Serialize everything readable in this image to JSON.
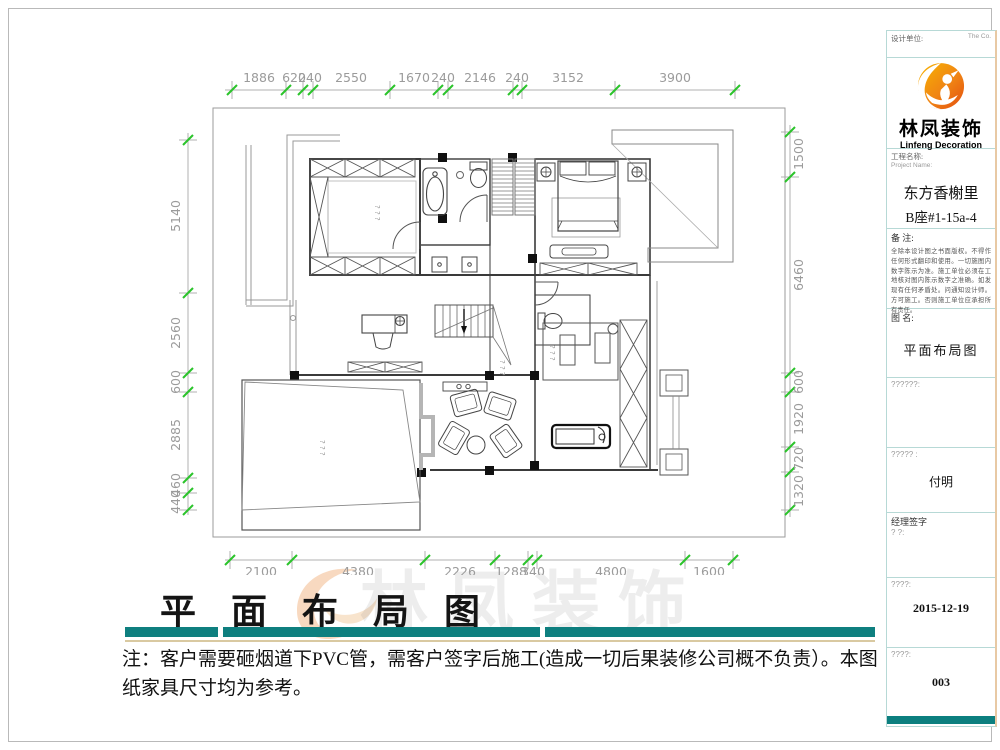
{
  "title_block": {
    "design_unit_label": "设计单位:",
    "design_unit_right": "The   Co.",
    "brand_cn": "林凤装饰",
    "brand_en": "Linfeng Decoration",
    "project_label": "工程名称:",
    "project_label_en": "Project Name:",
    "project_name": "东方香榭里",
    "project_unit": "B座#1-15a-4",
    "remark_label": "备  注:",
    "remark_text": "全除本设计图之书面版权。不得作任何形式翻印和使用。一切施图内数字陈示为准。施工单位必须在工地核对图内陈示数字之准确。如发现有任何矛盾处。问通知设计师。方可施工。否则施工单位应承担所有责任。",
    "drawing_name_label": "图  名:",
    "drawing_name": "平面布局图",
    "field_blank_label": "??????:",
    "designer_label": "?????  :",
    "designer_name": "付明",
    "manager_label": "经理签字",
    "manager_sub": "?     ?:",
    "date_label": "????:",
    "date_value": "2015-12-19",
    "sheet_label": "????:",
    "sheet_number": "003"
  },
  "footer": {
    "main_title": "平 面 布 局 图",
    "note": "注：客户需要砸烟道下PVC管，需客户签字后施工(造成一切后果装修公司概不负责）。本图纸家具尺寸均为参考。"
  },
  "watermark": {
    "text": "林凤装饰"
  },
  "dims": {
    "top": [
      "1886",
      "620",
      "240",
      "2550",
      "1670",
      "240",
      "2146",
      "240",
      "3152",
      "3900"
    ],
    "left": [
      "5140",
      "2560",
      "600",
      "2885",
      "460",
      "440"
    ],
    "right": [
      "1500",
      "6460",
      "600",
      "1920",
      "720",
      "1320"
    ],
    "bottom": [
      "2100",
      "4380",
      "2226",
      "1288",
      "340",
      "4800",
      "1600"
    ]
  },
  "plan": {
    "room_mark": "? ? ?"
  }
}
